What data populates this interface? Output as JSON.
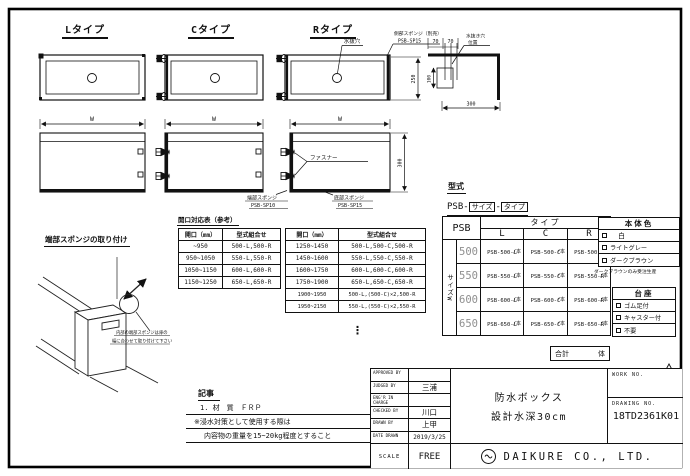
{
  "sheet": {
    "ink": "#111111",
    "background": "#ffffff"
  },
  "drawing": {
    "top_views": {
      "l_label": "Lタイプ",
      "c_label": "Cタイプ",
      "r_label": "Rタイプ",
      "drain_hole_label": "水抜穴",
      "side_sponge_label1": "側部スポンジ（別売）",
      "side_sponge_label2": "PSB-SP15",
      "width_dim": "W",
      "depth_dim": "250"
    },
    "detail": {
      "dim70": "70",
      "dim100": "100",
      "dim300": "300",
      "label1": "水抜き穴",
      "label2": "位置"
    },
    "front_views": {
      "width_dim": "W",
      "height_dim": "300",
      "fastener_label": "ファスナー",
      "end_sponge_label1": "端部スポンジ",
      "end_sponge_label2": "PSB-SP10",
      "bottom_sponge_label1": "底部スポンジ",
      "bottom_sponge_label2": "PSB-SP15"
    },
    "sponge_install": {
      "title": "端部スポンジの取り付け",
      "note1": "内部の端部スポンジは扉の",
      "note2": "幅に合わせて取り付けて下さい"
    }
  },
  "opening_table": {
    "title": "開口対応表（参考）",
    "headers": {
      "opening": "開口（mm）",
      "combo": "型式組合せ"
    },
    "table_a": [
      {
        "range": "~950",
        "combo": "500-L,500-R"
      },
      {
        "range": "950~1050",
        "combo": "550-L,550-R"
      },
      {
        "range": "1050~1150",
        "combo": "600-L,600-R"
      },
      {
        "range": "1150~1250",
        "combo": "650-L,650-R"
      }
    ],
    "table_b": [
      {
        "range": "1250~1450",
        "combo": "500-L,500-C,500-R"
      },
      {
        "range": "1450~1600",
        "combo": "550-L,550-C,550-R"
      },
      {
        "range": "1600~1750",
        "combo": "600-L,600-C,600-R"
      },
      {
        "range": "1750~1900",
        "combo": "650-L,650-C,650-R"
      },
      {
        "range": "1900~1950",
        "combo": "500-L,(500-C)×2,500-R"
      },
      {
        "range": "1950~2150",
        "combo": "550-L,(550-C)×2,550-R"
      }
    ],
    "ellipsis": "⋮"
  },
  "model_section": {
    "title": "型式",
    "prefix": "PSB-",
    "size_token": "サイズ",
    "separator": "-",
    "type_token": "タイプ",
    "table": {
      "corner": "PSB",
      "type_header": "タイプ",
      "col_l": "L",
      "col_c": "C",
      "col_r": "R",
      "size_axis": "サイズW",
      "unit": "/本",
      "rows": [
        {
          "size": "500",
          "l": "PSB-500-L",
          "c": "PSB-500-C",
          "r": "PSB-500-R"
        },
        {
          "size": "550",
          "l": "PSB-550-L",
          "c": "PSB-550-C",
          "r": "PSB-550-R"
        },
        {
          "size": "600",
          "l": "PSB-600-L",
          "c": "PSB-600-C",
          "r": "PSB-600-R"
        },
        {
          "size": "650",
          "l": "PSB-650-L",
          "c": "PSB-650-C",
          "r": "PSB-650-R"
        }
      ]
    },
    "body_color": {
      "title": "本体色",
      "options": [
        "白",
        "ライトグレー",
        "ダークブラウン"
      ],
      "note": "ダークブラウンのみ受注生産"
    },
    "base": {
      "title": "台座",
      "options": [
        "ゴム足付",
        "キャスター付",
        "不要"
      ]
    },
    "total_label": "合計",
    "total_unit": "体"
  },
  "notes": {
    "title": "記事",
    "line1": "1. 材　質　ＦＲＰ",
    "line2": "※浸水対策として使用する際は",
    "line3": "内容物の重量を15~20kg程度とすること"
  },
  "title_block": {
    "rows": [
      {
        "label": "APPROVED BY",
        "value": ""
      },
      {
        "label": "JUDGED BY",
        "value": "三浦"
      },
      {
        "label": "ENG'R IN CHARGE",
        "value": ""
      },
      {
        "label": "CHECKED BY",
        "value": "川口"
      },
      {
        "label": "DRAWN BY",
        "value": "上甲"
      },
      {
        "label": "DATE DRAWN",
        "value": "2019/3/25"
      }
    ],
    "scale_label": "SCALE",
    "scale_value": "FREE",
    "title_line1": "防水ボックス",
    "title_line2": "設計水深30cm",
    "work_no_label": "WORK NO.",
    "drawing_no_label": "DRAWING NO.",
    "drawing_no": "18TD2361K01",
    "company": "DAIKURE CO., LTD."
  }
}
